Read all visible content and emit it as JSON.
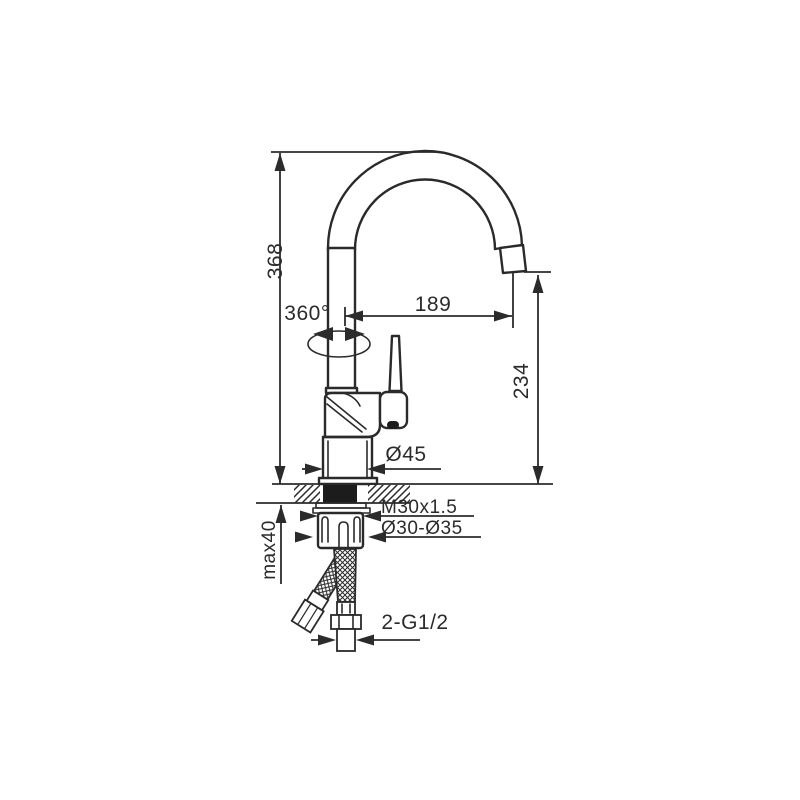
{
  "page": {
    "background": "#ffffff"
  },
  "drawing": {
    "title": "kitchen-faucet-installation-technical-drawing",
    "line_color": "#2a2a2a",
    "dims": {
      "overall_height": "368",
      "spout_reach": "189",
      "swivel": "360°",
      "outlet_height": "234",
      "base_diameter": "Ø45",
      "mounting_thread": "M30x1.5",
      "hole_diameter": "Ø30-Ø35",
      "max_deck_thickness": "max40",
      "hose_connection": "2-G1/2"
    }
  }
}
